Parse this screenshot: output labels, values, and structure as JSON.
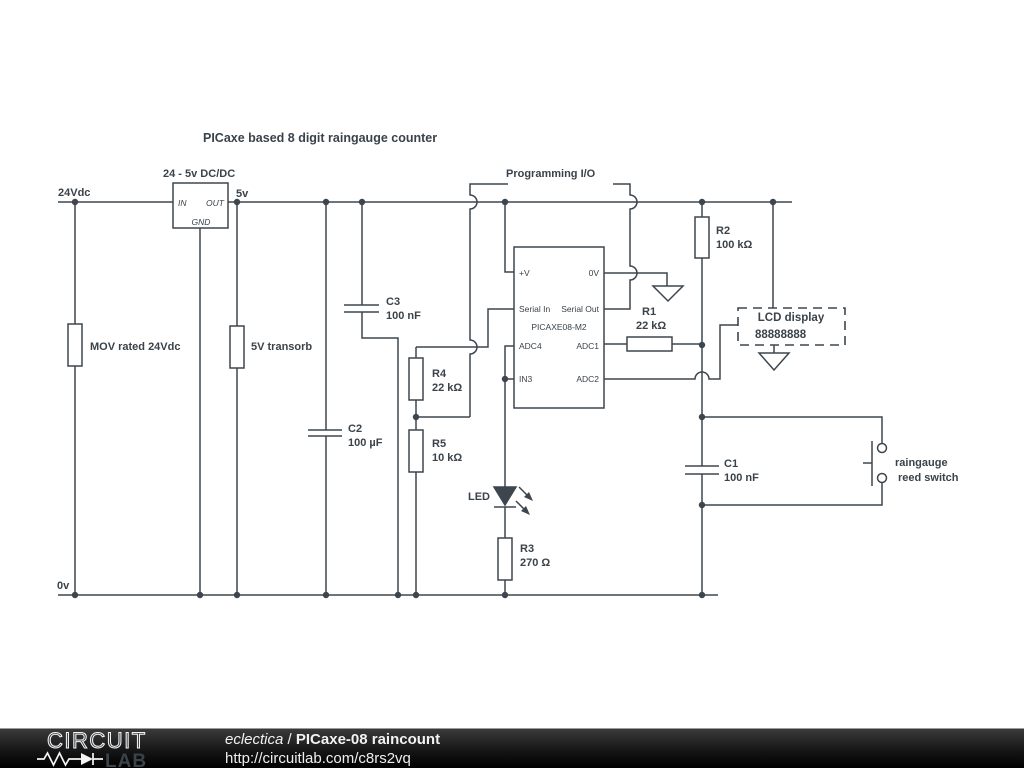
{
  "title": "PICaxe based 8 digit raingauge counter",
  "power": {
    "v24": "24Vdc",
    "v5": "5v",
    "v0": "0v"
  },
  "dcdc": {
    "label": "24 - 5v DC/DC",
    "pin_in": "IN",
    "pin_out": "OUT",
    "pin_gnd": "GND"
  },
  "protection": {
    "mov": "MOV rated 24Vdc",
    "transorb": "5V transorb"
  },
  "programming": {
    "label": "Programming I/O"
  },
  "components": {
    "c1": {
      "ref": "C1",
      "value": "100 nF"
    },
    "c2": {
      "ref": "C2",
      "value": "100 µF"
    },
    "c3": {
      "ref": "C3",
      "value": "100 nF"
    },
    "r1": {
      "ref": "R1",
      "value": "22 kΩ"
    },
    "r2": {
      "ref": "R2",
      "value": "100 kΩ"
    },
    "r3": {
      "ref": "R3",
      "value": "270 Ω"
    },
    "r4": {
      "ref": "R4",
      "value": "22 kΩ"
    },
    "r5": {
      "ref": "R5",
      "value": "10 kΩ"
    },
    "led": {
      "ref": "LED"
    }
  },
  "chip": {
    "name": "PICAXE08-M2",
    "pin_vplus": "+V",
    "pin_0v": "0V",
    "pin_serial_in": "Serial In",
    "pin_serial_out": "Serial Out",
    "pin_adc4": "ADC4",
    "pin_adc1": "ADC1",
    "pin_in3": "IN3",
    "pin_adc2": "ADC2"
  },
  "lcd": {
    "title": "LCD display",
    "digits": "88888888"
  },
  "reed_switch": {
    "line1": "raingauge",
    "line2": "reed switch"
  },
  "colors": {
    "wire": "#3d464e",
    "background": "#ffffff",
    "footer_bg": "#1a1a1a",
    "footer_text": "#f2f2f2"
  },
  "footer": {
    "logo_line1": "CIRCUIT",
    "logo_line2": "LAB",
    "author": "eclectica",
    "divider": "/",
    "schematic_title": "PICaxe-08 raincount",
    "url": "http://circuitlab.com/c8rs2vq"
  }
}
